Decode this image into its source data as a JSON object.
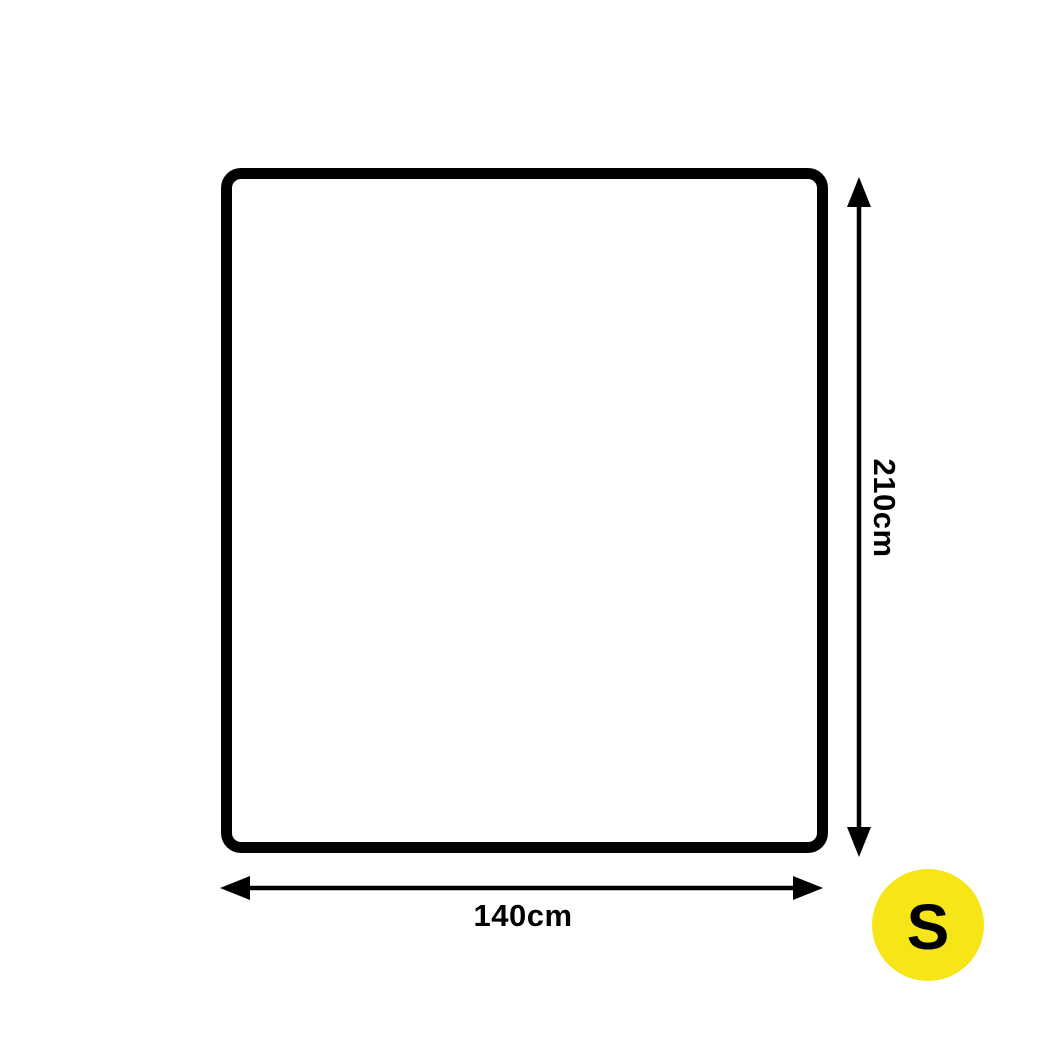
{
  "diagram": {
    "width_label": "140cm",
    "height_label": "210cm",
    "badge_label": "S",
    "colors": {
      "outline": "#000000",
      "dimension_lines": "#000000",
      "label_text": "#000000",
      "badge_background": "#F7E617",
      "badge_text": "#000000"
    }
  }
}
